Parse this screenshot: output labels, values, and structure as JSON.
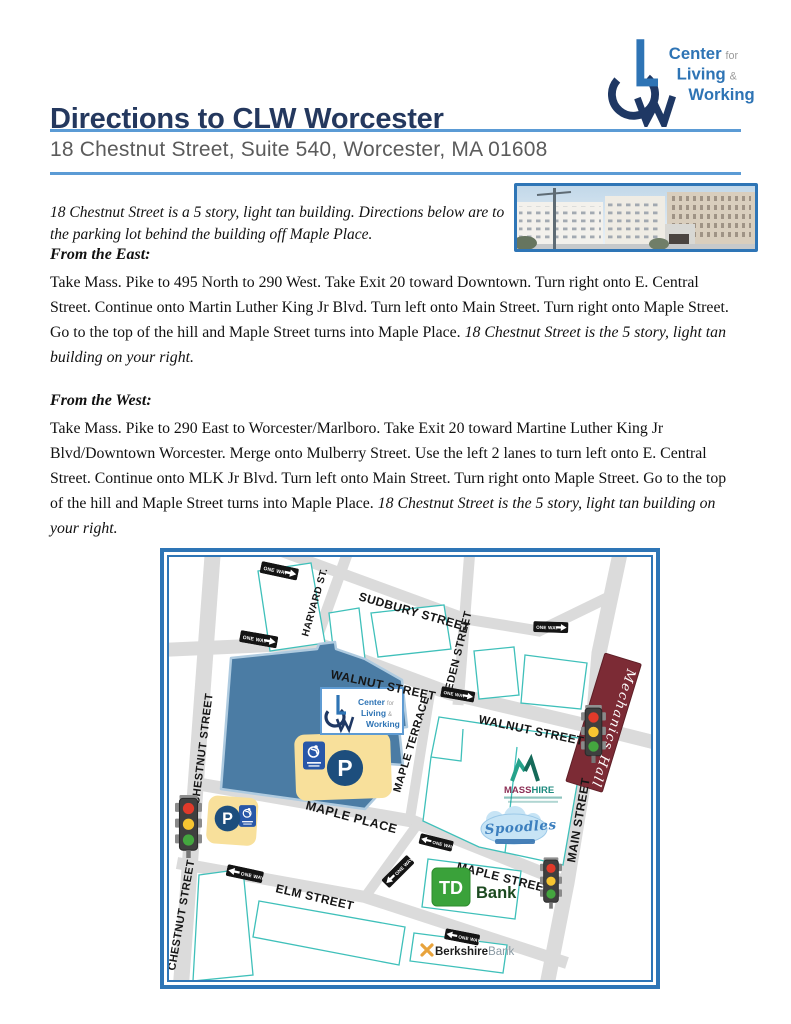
{
  "header": {
    "title": "Directions to CLW Worcester",
    "subtitle": "18 Chestnut Street, Suite 540, Worcester, MA 01608"
  },
  "logo": {
    "org_line1": "Center",
    "org_line1_suffix": "for",
    "org_line2": "Living",
    "org_line2_suffix": "&",
    "org_line3": "Working"
  },
  "intro": {
    "text": "18 Chestnut Street is a 5 story, light tan building. Directions below are to the parking lot behind the building off Maple Place."
  },
  "sections": [
    {
      "heading": "From the East:",
      "body": "Take Mass. Pike to 495 North to 290 West. Take Exit 20 toward Downtown. Turn right onto E. Central Street. Continue onto Martin Luther King Jr Blvd. Turn left onto Main Street. Turn right onto Maple Street. Go to the top of the hill and Maple Street turns into Maple Place.",
      "italic_note": "18 Chestnut Street is the 5 story, light tan building on your right."
    },
    {
      "heading": "From the West:",
      "body": "Take Mass. Pike to 290 East to Worcester/Marlboro. Take Exit 20 toward Martine Luther King Jr Blvd/Downtown Worcester. Merge onto Mulberry Street. Use the left 2 lanes to turn left onto E. Central Street. Continue onto MLK Jr Blvd. Turn left onto Main Street. Turn right onto Maple Street. Go to the top of the hill and Maple Street turns into Maple Place.",
      "italic_note": "18 Chestnut Street is the 5 story, light tan building on your right."
    }
  ],
  "map": {
    "one_way_label": "ONE WAY",
    "streets": {
      "harvard": "HARVARD ST.",
      "sudbury": "SUDBURY STREET",
      "eden": "EDEN STREET",
      "walnut": "WALNUT STREET",
      "chestnut": "CHESTNUT STREET",
      "maple_terrace": "MAPLE TERRACE",
      "maple_place": "MAPLE PLACE",
      "main": "MAIN STREET",
      "elm": "ELM STREET",
      "maple": "MAPLE STREET"
    },
    "landmarks": {
      "mechanics_hall": "Mechanics Hall",
      "masshire_part1": "MASS",
      "masshire_part2": "HIRE",
      "spoodles": "Spoodles",
      "td_initials": "TD",
      "td_bank_word": "Bank",
      "berkshire_word1": "Berkshire",
      "berkshire_word2": "Bank",
      "parking_letter": "P"
    }
  },
  "colors": {
    "accent_blue": "#2E75B6",
    "rule_blue": "#5B9BD5",
    "title_navy": "#24385E",
    "logo_blue": "#2E74B5",
    "logo_navy": "#1F3864",
    "road_gray": "#DBDBDB",
    "building_outline_teal": "#3FC0BA",
    "clw_building_blue": "#4B7CA4",
    "parking_lot_yellow": "#F8E09B",
    "handicap_blue": "#2857A8",
    "p_circle_navy": "#1D4E7D",
    "mechanics_hall_maroon": "#7C2B35",
    "td_green": "#3AA23A",
    "berkshire_gold": "#E8A33C",
    "masshire_teal": "#1D8A7E",
    "masshire_maroon": "#8C2F55",
    "spoodles_blue": "#3C7FBE"
  }
}
